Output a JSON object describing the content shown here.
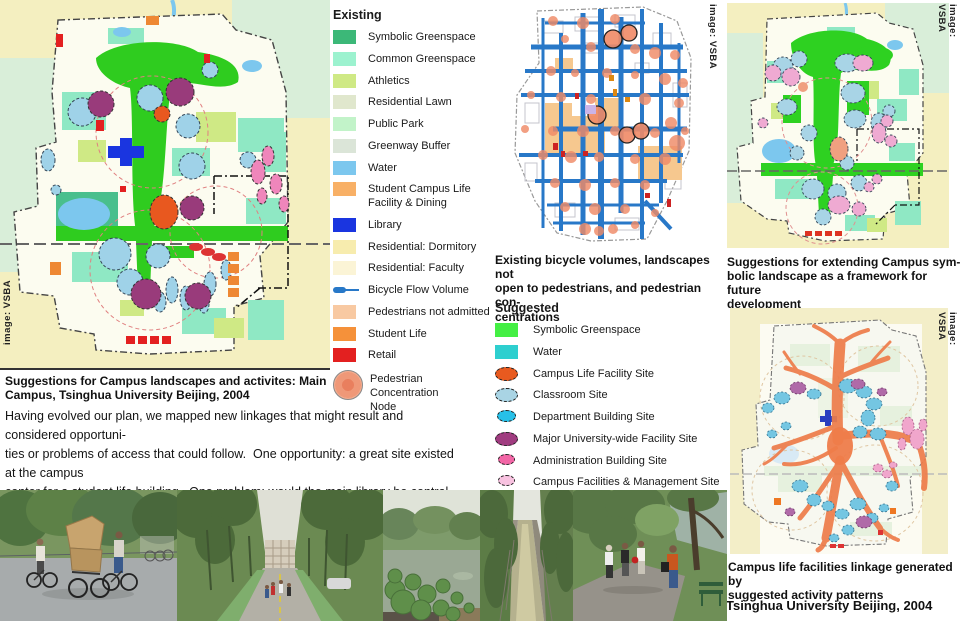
{
  "credit": "image: VSBA",
  "legend_existing": {
    "title": "Existing",
    "items": [
      {
        "label": "Symbolic Greenspace",
        "color": "#3cb878",
        "shape": "square"
      },
      {
        "label": "Common Greenspace",
        "color": "#9cf2cf",
        "shape": "square"
      },
      {
        "label": "Athletics",
        "color": "#cfe985",
        "shape": "square"
      },
      {
        "label": "Residential Lawn",
        "color": "#e0e7cd",
        "shape": "square"
      },
      {
        "label": "Public Park",
        "color": "#c2f3c9",
        "shape": "square"
      },
      {
        "label": "Greenway Buffer",
        "color": "#dbe5d8",
        "shape": "square"
      },
      {
        "label": "Water",
        "color": "#7cc7ee",
        "shape": "square"
      },
      {
        "label": "Student Campus Life\nFacility & Dining",
        "color": "#f8b066",
        "shape": "square"
      },
      {
        "label": "Library",
        "color": "#1a35e0",
        "shape": "square"
      },
      {
        "label": "Residential: Dormitory",
        "color": "#f7ecae",
        "shape": "square"
      },
      {
        "label": "Residential: Faculty",
        "color": "#fbf4d6",
        "shape": "square"
      },
      {
        "label": "Bicycle Flow Volume",
        "color": "#2878c8",
        "shape": "line"
      },
      {
        "label": "Pedestrians not admitted",
        "color": "#f8c9a2",
        "shape": "square"
      },
      {
        "label": "Student Life",
        "color": "#f5913a",
        "shape": "square"
      },
      {
        "label": "Retail",
        "color": "#e32020",
        "shape": "square"
      },
      {
        "label": "Pedestrian Concentration\nNode",
        "color": "#ef9878",
        "shape": "node"
      }
    ]
  },
  "legend_suggested": {
    "title": "Suggested",
    "items": [
      {
        "label": "Symbolic Greenspace",
        "color": "#44ef44",
        "shape": "square"
      },
      {
        "label": "Water",
        "color": "#2ecfcf",
        "shape": "square"
      },
      {
        "label": "Campus Life Facility Site",
        "color": "#e85a1f",
        "shape": "ellipse"
      },
      {
        "label": "Classroom Site",
        "color": "#a9d4e4",
        "shape": "ellipse"
      },
      {
        "label": "Department Building Site",
        "color": "#27c0e8",
        "shape": "ellipse"
      },
      {
        "label": "Major University-wide Facility Site",
        "color": "#a03c80",
        "shape": "ellipse"
      },
      {
        "label": "Administration Building Site",
        "color": "#f266a6",
        "shape": "ellipse"
      },
      {
        "label": "Campus Facilities & Management Site",
        "color": "#f8c2e0",
        "shape": "ellipse"
      }
    ]
  },
  "maps": {
    "main": {
      "caption": "Suggestions for Campus landscapes and activites: Main\nCampus, Tsinghua University Beijing, 2004"
    },
    "bicycle": {
      "caption": "Existing bicycle volumes, landscapes not\nopen to pedestrians, and pedestrian con-\ncentrations"
    },
    "extend": {
      "caption": "Suggestions for extending Campus sym-\nbolic landscape as a framework for future\ndevelopment"
    },
    "linkage": {
      "caption": "Campus life facilities linkage generated by\nsuggested activity patterns",
      "source": "Tsinghua University Beijing, 2004"
    }
  },
  "paragraph": "Having evolved our plan, we mapped new linkages that might result and considered opportuni-\nties or problems of access that could follow.  One opportunity: a great site existed at the campus\ncenter for a student life building.  One problem: would the main library be central enough? There-\nafter we developed indicative site and building plans for two key projects.",
  "photos": [
    {
      "name": "bicycle-cart-street"
    },
    {
      "name": "tree-lined-avenue"
    },
    {
      "name": "lotus-pond"
    },
    {
      "name": "campus-canal"
    },
    {
      "name": "lakeside-path"
    }
  ]
}
